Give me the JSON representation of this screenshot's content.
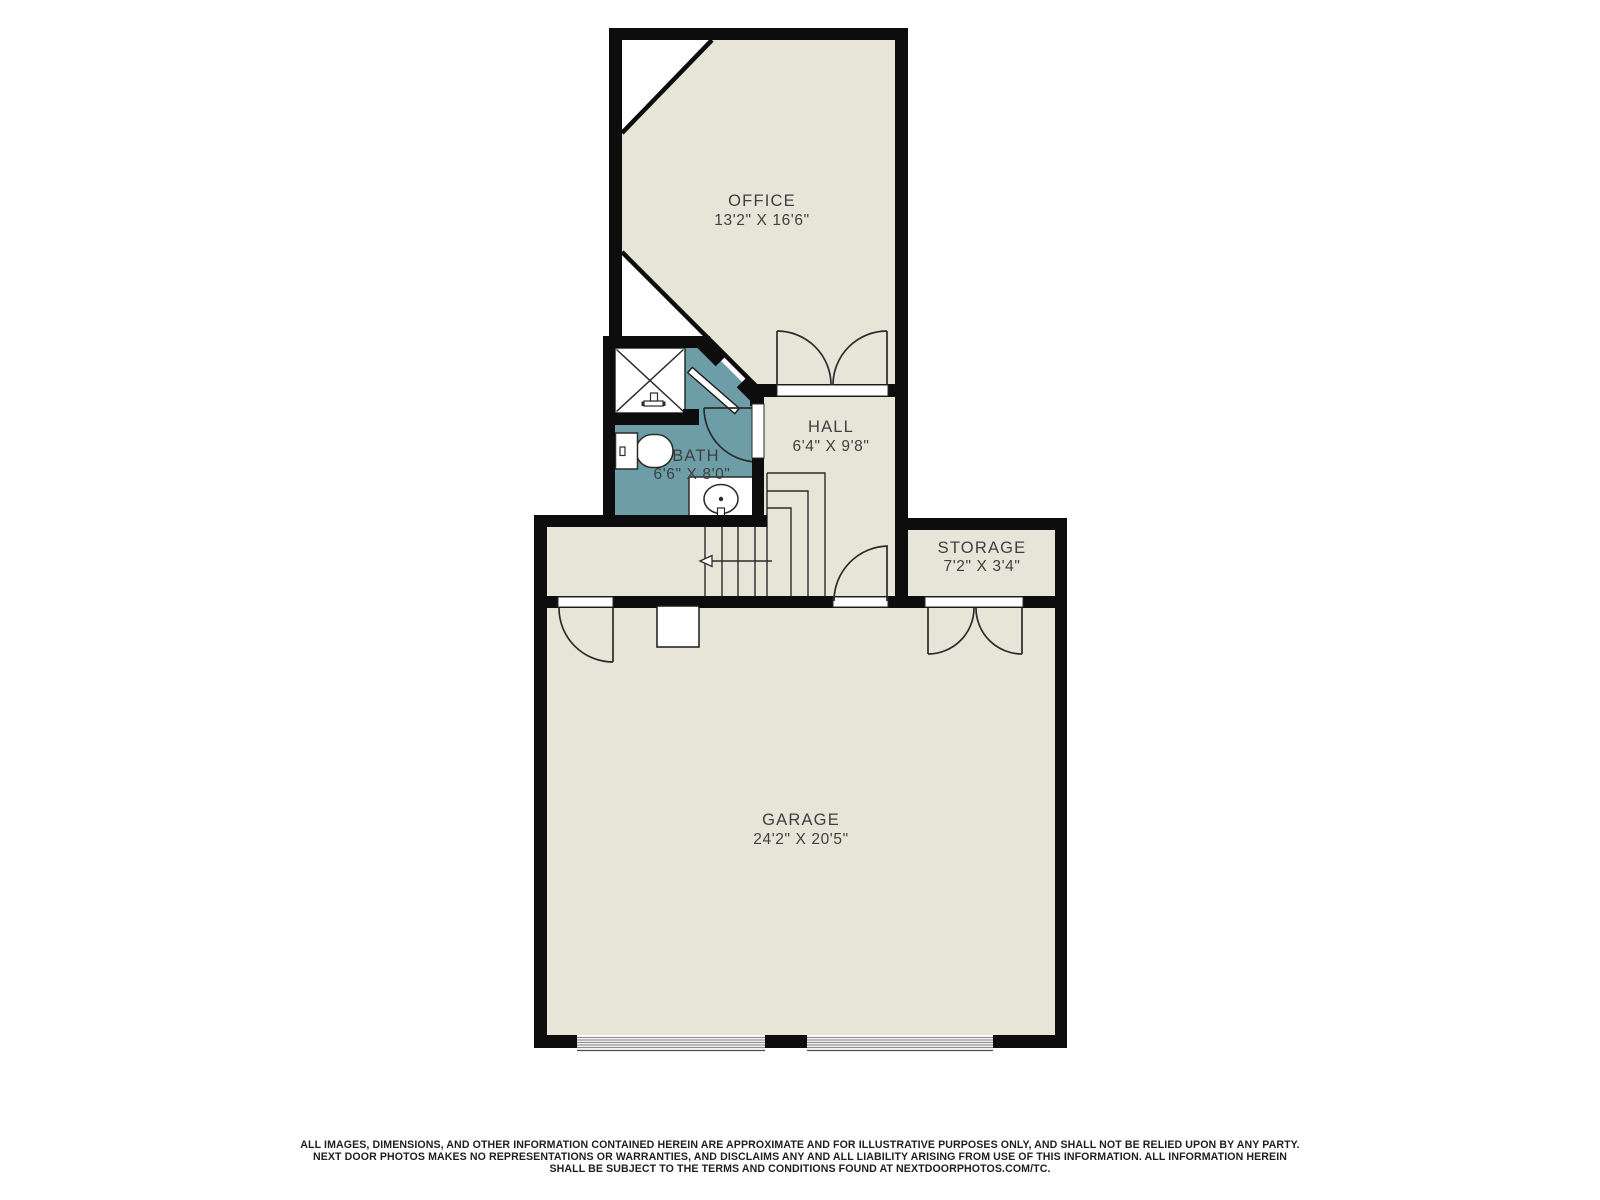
{
  "plan": {
    "colors": {
      "floor": "#e7e5d8",
      "bath_floor": "#6d9ea8",
      "wall": "#0d0d0d",
      "line": "#2b2b2b",
      "label_text": "#3f3f3f"
    },
    "rooms": [
      {
        "name": "office",
        "label": "OFFICE",
        "dims": "13'2\" X 16'6\""
      },
      {
        "name": "bath",
        "label": "BATH",
        "dims": "6'6\" X 8'0\""
      },
      {
        "name": "hall",
        "label": "HALL",
        "dims": "6'4\" X 9'8\""
      },
      {
        "name": "storage",
        "label": "STORAGE",
        "dims": "7'2\" X 3'4\""
      },
      {
        "name": "garage",
        "label": "GARAGE",
        "dims": "24'2\" X 20'5\""
      }
    ],
    "fixtures": [
      "shower",
      "toilet",
      "sink-vanity",
      "furnace",
      "stairs",
      "garage-doors"
    ]
  },
  "footer": {
    "line1": "ALL IMAGES, DIMENSIONS, AND OTHER INFORMATION CONTAINED HEREIN ARE APPROXIMATE AND FOR ILLUSTRATIVE PURPOSES ONLY, AND SHALL NOT BE RELIED UPON BY ANY PARTY.",
    "line2": "NEXT DOOR PHOTOS MAKES NO REPRESENTATIONS OR WARRANTIES, AND DISCLAIMS ANY AND ALL LIABILITY ARISING FROM USE OF THIS INFORMATION. ALL INFORMATION HEREIN",
    "line3": "SHALL BE SUBJECT TO THE TERMS AND CONDITIONS FOUND AT NEXTDOORPHOTOS.COM/TC."
  }
}
